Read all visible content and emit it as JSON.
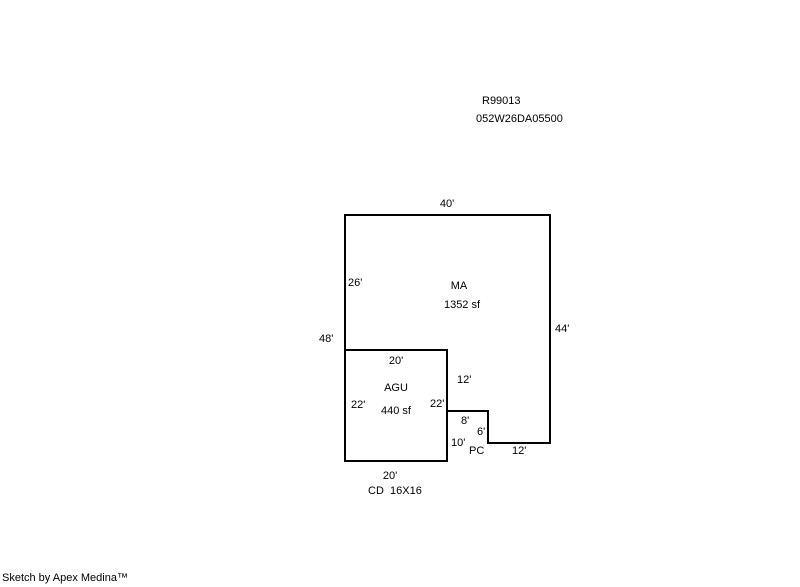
{
  "header": {
    "record_number": "R99013",
    "parcel_number": "052W26DA05500"
  },
  "sketch": {
    "areas": {
      "ma": {
        "code": "MA",
        "size": "1352 sf"
      },
      "agu": {
        "code": "AGU",
        "size": "440 sf"
      },
      "pc": {
        "code": "PC"
      },
      "cd": {
        "code": "CD  16X16"
      }
    },
    "dimensions": {
      "top": "40'",
      "left_upper": "26'",
      "left_total": "48'",
      "right": "44'",
      "agu_top": "20'",
      "agu_left": "22'",
      "agu_right": "22'",
      "agu_bottom": "20'",
      "step_upper": "12'",
      "step_top": "8'",
      "step_right": "6'",
      "step_lower": "10'",
      "bottom_right": "12'"
    },
    "line_color": "#000000",
    "background_color": "#ffffff"
  },
  "footer": {
    "credit": "Sketch by Apex Medina™"
  }
}
